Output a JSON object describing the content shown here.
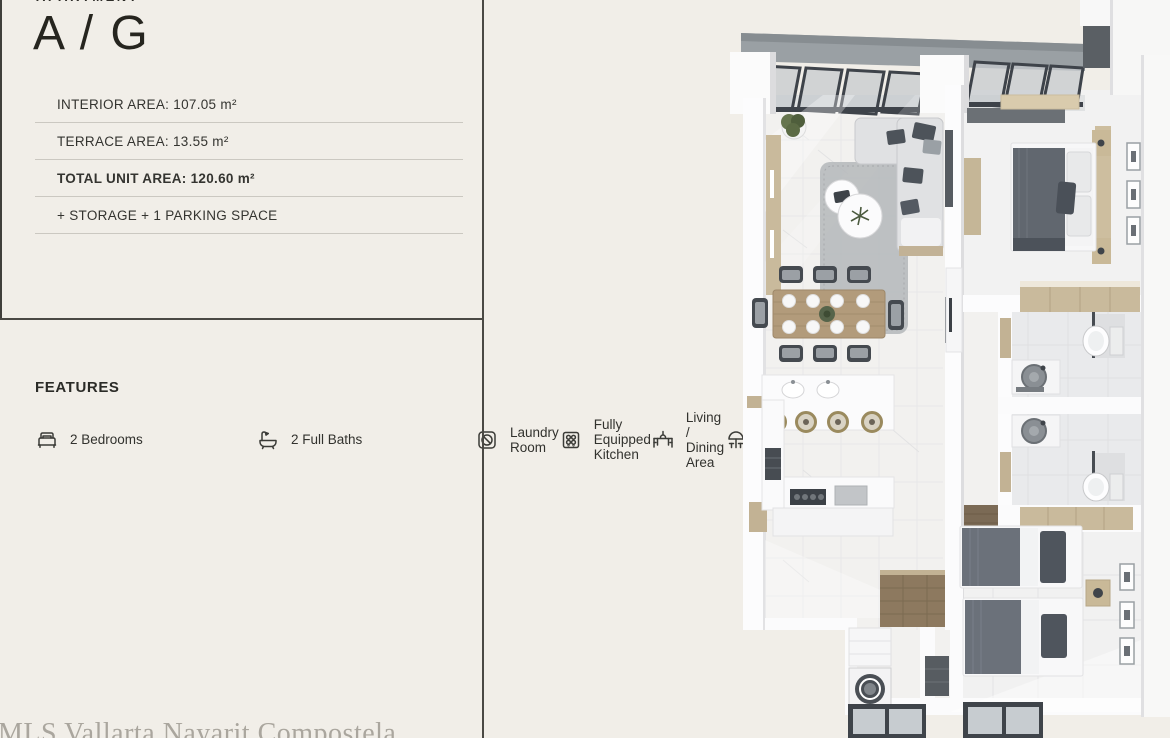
{
  "header": {
    "eyebrow": "APARTMENT",
    "title": "A / G"
  },
  "specs": [
    {
      "text": "INTERIOR AREA: 107.05 m²",
      "bold": false
    },
    {
      "text": "TERRACE AREA: 13.55 m²",
      "bold": false
    },
    {
      "text": "TOTAL UNIT AREA: 120.60 m²",
      "bold": true
    },
    {
      "text": "+ STORAGE + 1 PARKING SPACE",
      "bold": false
    }
  ],
  "features": {
    "heading": "FEATURES",
    "items": [
      {
        "icon": "bed-icon",
        "label": "2 Bedrooms"
      },
      {
        "icon": "bathtub-icon",
        "label": "2 Full Baths"
      },
      {
        "icon": "washing-machine-icon",
        "label": "Laundry Room"
      },
      {
        "icon": "stove-icon",
        "label": "Fully Equipped Kitchen"
      },
      {
        "icon": "dining-table-icon",
        "label": "Living / Dining Area"
      },
      {
        "icon": "umbrella-icon",
        "label": "Terrace"
      }
    ]
  },
  "watermark": "MLS Vallarta Nayarit Compostela",
  "floor_plan": {
    "kind": "3d-top-down-render",
    "rooms": [
      "terrace",
      "living-room",
      "dining-area",
      "kitchen",
      "master-bedroom",
      "bathroom-1",
      "bathroom-2",
      "second-bedroom",
      "laundry-room",
      "hallway",
      "entry"
    ]
  },
  "colors": {
    "page_background": "#f1eee8",
    "ink": "#2e2d29",
    "rule_dark": "#4a4944",
    "rule_light": "#cbc8c1",
    "watermark": "#aaa69e",
    "plan_wall": "#fcfcfd",
    "plan_floor": "#f2f1ef",
    "plan_wood": "#c9ba9c",
    "plan_furniture_dark": "#545a62",
    "plan_glass_frame": "#3e434a"
  }
}
